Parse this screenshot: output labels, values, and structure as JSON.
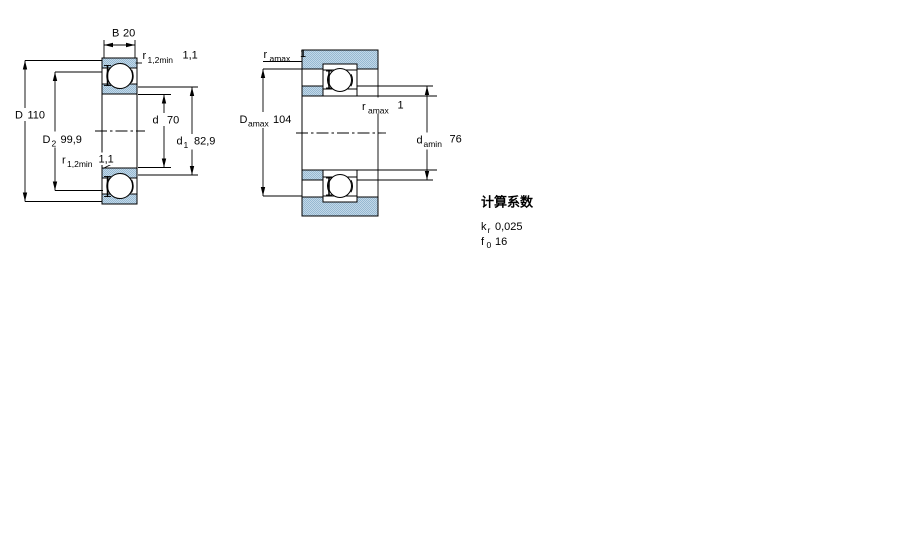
{
  "section_view": {
    "dim_B": {
      "symbol": "B",
      "value": "20"
    },
    "dim_r12_top": {
      "symbol": "r",
      "subscript": "1,2min",
      "value": "1,1"
    },
    "dim_D": {
      "symbol": "D",
      "value": "110"
    },
    "dim_D2": {
      "symbol": "D",
      "subscript": "2",
      "value": "99,9"
    },
    "dim_d": {
      "symbol": "d",
      "value": "70"
    },
    "dim_d1": {
      "symbol": "d",
      "subscript": "1",
      "value": "82,9"
    },
    "dim_r12_bottom": {
      "symbol": "r",
      "subscript": "1,2min",
      "value": "1,1"
    }
  },
  "mounting_view": {
    "dim_ra_top": {
      "symbol": "r",
      "subscript": "amax",
      "value": "1"
    },
    "dim_Da": {
      "symbol": "D",
      "subscript": "amax",
      "value": "104"
    },
    "dim_ra_mid": {
      "symbol": "r",
      "subscript": "amax",
      "value": "1"
    },
    "dim_da": {
      "symbol": "d",
      "subscript": "amin",
      "value": "76"
    }
  },
  "calculation_factors": {
    "title": "计算系数",
    "kr": {
      "symbol": "k",
      "subscript": "r",
      "value": "0,025"
    },
    "f0": {
      "symbol": "f",
      "subscript": "0",
      "value": "16"
    }
  },
  "colors": {
    "line": "#000000",
    "shading_light": "#c3d8e8",
    "shading_dark": "#96b9d2",
    "background": "#ffffff"
  }
}
